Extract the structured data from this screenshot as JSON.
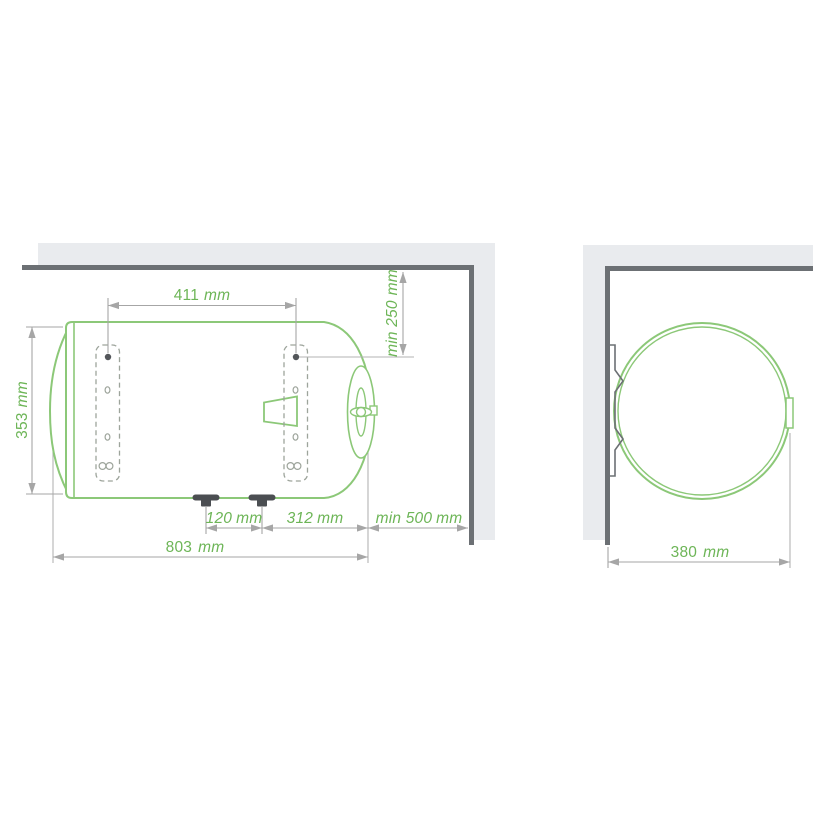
{
  "diagram": {
    "subject": "horizontal-water-heater-mounting-dimensions",
    "views": {
      "side_view": "side view with wall corner",
      "front_view": "end view with wall"
    },
    "dimensions": {
      "bracket_spacing": {
        "value": "411",
        "unit": "mm"
      },
      "min_top_clearance": {
        "value": "min 250",
        "unit": "mm"
      },
      "body_height": {
        "value": "353",
        "unit": "mm"
      },
      "feet_spacing": {
        "value": "120",
        "unit": "mm"
      },
      "foot_to_end": {
        "value": "312",
        "unit": "mm"
      },
      "min_side_clearance": {
        "value": "min 500",
        "unit": "mm"
      },
      "overall_length": {
        "value": "803",
        "unit": "mm"
      },
      "diameter": {
        "value": "380",
        "unit": "mm"
      }
    },
    "colors": {
      "outline_green": "#8cc878",
      "text_green": "#6db557",
      "dimension_gray": "#a6a6a6",
      "wall_light": "#e9ebee",
      "wall_dark": "#6c7074",
      "feet_dark": "#4b4e52",
      "bracket_dash_gray": "#9da49b"
    }
  }
}
